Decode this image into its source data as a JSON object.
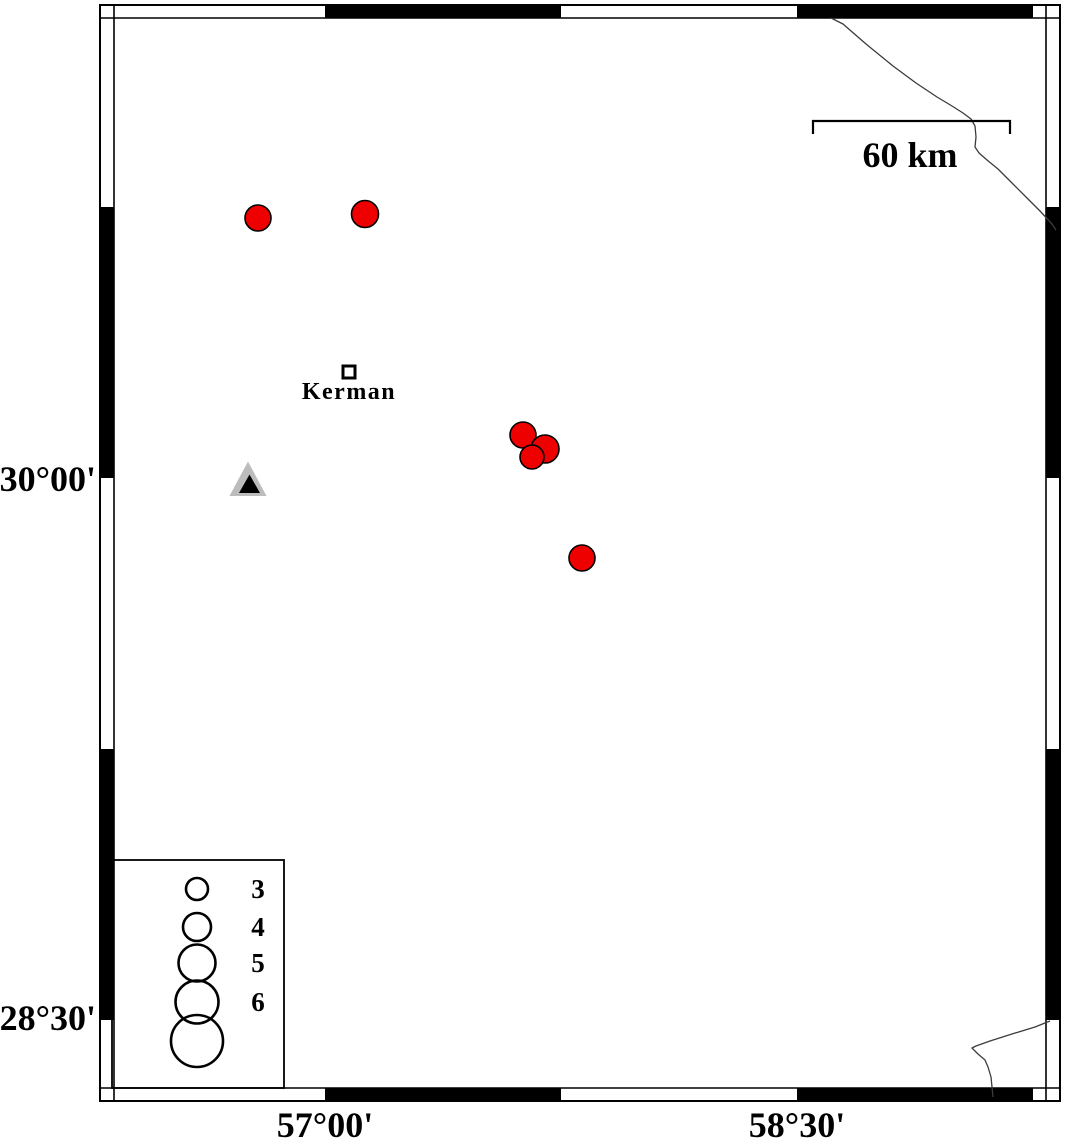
{
  "colors": {
    "background": "#ffffff",
    "frame": "#000000",
    "epicenter_fill": "#ee0000",
    "epicenter_stroke": "#000000",
    "station_outer": "#bcbcbc",
    "station_inner": "#000000",
    "boundary_line": "#3c3c3c"
  },
  "frame": {
    "outer": {
      "x": 100,
      "y": 5,
      "w": 960,
      "h": 1096
    },
    "inner": {
      "x": 114,
      "y": 18,
      "w": 932,
      "h": 1070
    },
    "top_bottom_transitions_x": [
      325,
      561,
      797,
      1033
    ],
    "left_right_transitions_y": [
      207,
      478,
      749,
      1020
    ]
  },
  "axis_labels": {
    "left": [
      {
        "text": "30°00'",
        "y": 478
      },
      {
        "text": "28°30'",
        "y": 1017
      }
    ],
    "bottom": [
      {
        "text": "57°00'",
        "x": 325
      },
      {
        "text": "58°30'",
        "x": 797
      }
    ]
  },
  "scale_bar": {
    "label": "60 km",
    "x1": 813,
    "x2": 1010,
    "y": 121,
    "tick_drop": 13,
    "label_x": 910,
    "label_y": 167
  },
  "city": {
    "label": "Kerman",
    "square": {
      "x": 343,
      "y": 366,
      "size": 12
    },
    "label_x": 349,
    "label_y": 399
  },
  "station": {
    "outer_points": "248,461.5 229.5,496 266.5,496",
    "inner_points": "249.5,474.5 239,493 260,493"
  },
  "epicenters": [
    {
      "x": 258,
      "y": 218,
      "r": 13
    },
    {
      "x": 365,
      "y": 214,
      "r": 13.5
    },
    {
      "x": 523,
      "y": 435,
      "r": 13
    },
    {
      "x": 545,
      "y": 449,
      "r": 14
    },
    {
      "x": 532,
      "y": 457,
      "r": 12
    },
    {
      "x": 582,
      "y": 558,
      "r": 13
    }
  ],
  "boundary_lines": [
    {
      "name": "northeast-border",
      "points": [
        [
          831,
          18
        ],
        [
          843,
          24
        ],
        [
          866,
          44
        ],
        [
          893,
          66
        ],
        [
          916,
          83
        ],
        [
          937,
          97
        ],
        [
          952,
          106
        ],
        [
          963,
          113
        ],
        [
          971,
          119
        ],
        [
          975,
          126
        ],
        [
          976,
          137
        ],
        [
          975,
          147
        ],
        [
          979,
          153
        ],
        [
          987,
          160
        ],
        [
          998,
          169
        ],
        [
          1011,
          182
        ],
        [
          1026,
          197
        ],
        [
          1040,
          211
        ],
        [
          1052,
          224
        ],
        [
          1056,
          230
        ]
      ]
    },
    {
      "name": "southeast-border",
      "points": [
        [
          1050,
          1021
        ],
        [
          1035,
          1027
        ],
        [
          1012,
          1034
        ],
        [
          990,
          1041
        ],
        [
          976,
          1046
        ],
        [
          972,
          1048
        ],
        [
          978,
          1054
        ],
        [
          985,
          1060
        ],
        [
          988,
          1067
        ],
        [
          991,
          1077
        ],
        [
          992,
          1087
        ],
        [
          993,
          1097
        ]
      ]
    }
  ],
  "legend": {
    "box": {
      "x": 112,
      "y": 860,
      "w": 172,
      "h": 228
    },
    "circle_cx": 197,
    "label_x": 258,
    "entries": [
      {
        "cy": 889,
        "r": 11,
        "label": "3"
      },
      {
        "cy": 927,
        "r": 14,
        "label": "4"
      },
      {
        "cy": 963,
        "r": 18.5,
        "label": "5"
      },
      {
        "cy": 1002,
        "r": 21.5,
        "label": "6"
      },
      {
        "cy": 1041,
        "r": 26,
        "label": ""
      }
    ]
  }
}
